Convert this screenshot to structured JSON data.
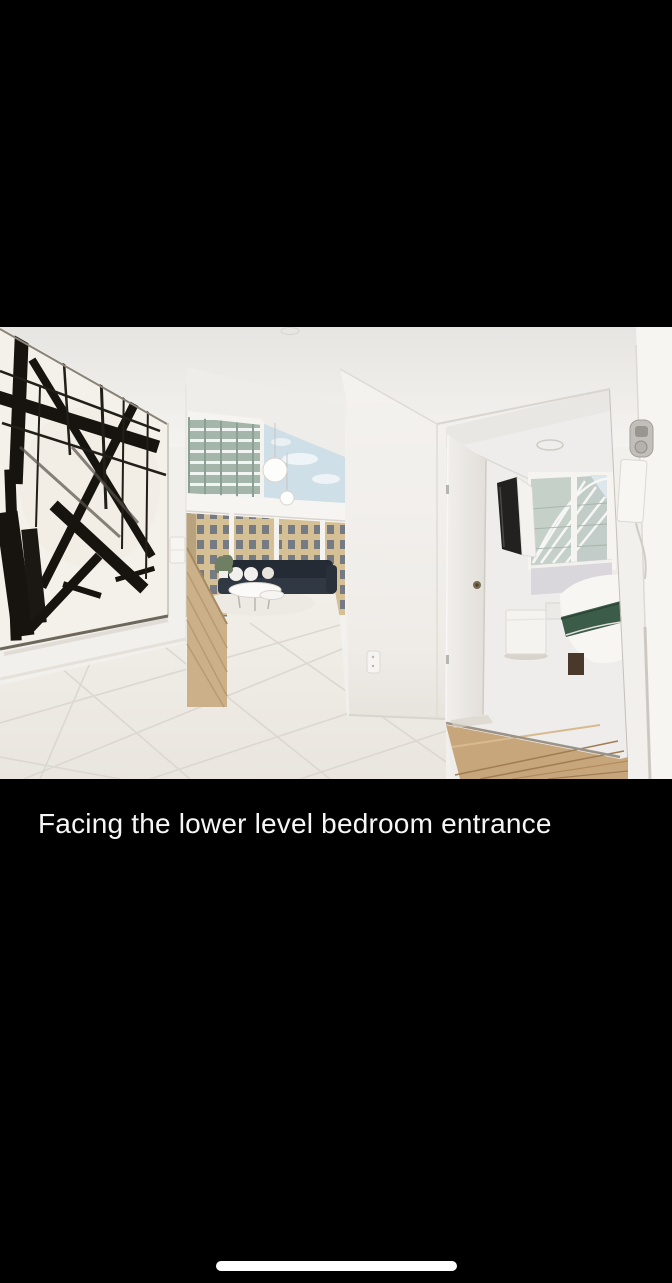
{
  "screen": {
    "background_color": "#000000",
    "width": 672,
    "height": 1283
  },
  "photo_viewer": {
    "photo_alt": "Hallway photo facing the lower level bedroom entrance",
    "caption": {
      "text": "Facing the lower level bedroom entrance",
      "color": "#f6f6f6"
    },
    "scene_palette": {
      "wall_white": "#f2f0ed",
      "ceiling_shade": "#e9e7e4",
      "floor_tile": "#efece6",
      "tile_grout": "#dcd8d1",
      "art_black": "#17140f",
      "stair_wood": "#ccb08a",
      "bedroom_wood": "#c8a67c",
      "sofa_navy": "#252b34",
      "blanket_green": "#3c5c4a",
      "window_glass": "#c5d0c9",
      "sky_blue": "#cfdfe8",
      "tower_green": "#a3b6a9",
      "building_beige": "#d5c096",
      "lavender_wall": "#d9d7db"
    }
  },
  "system": {
    "home_indicator_color": "#ffffff"
  }
}
